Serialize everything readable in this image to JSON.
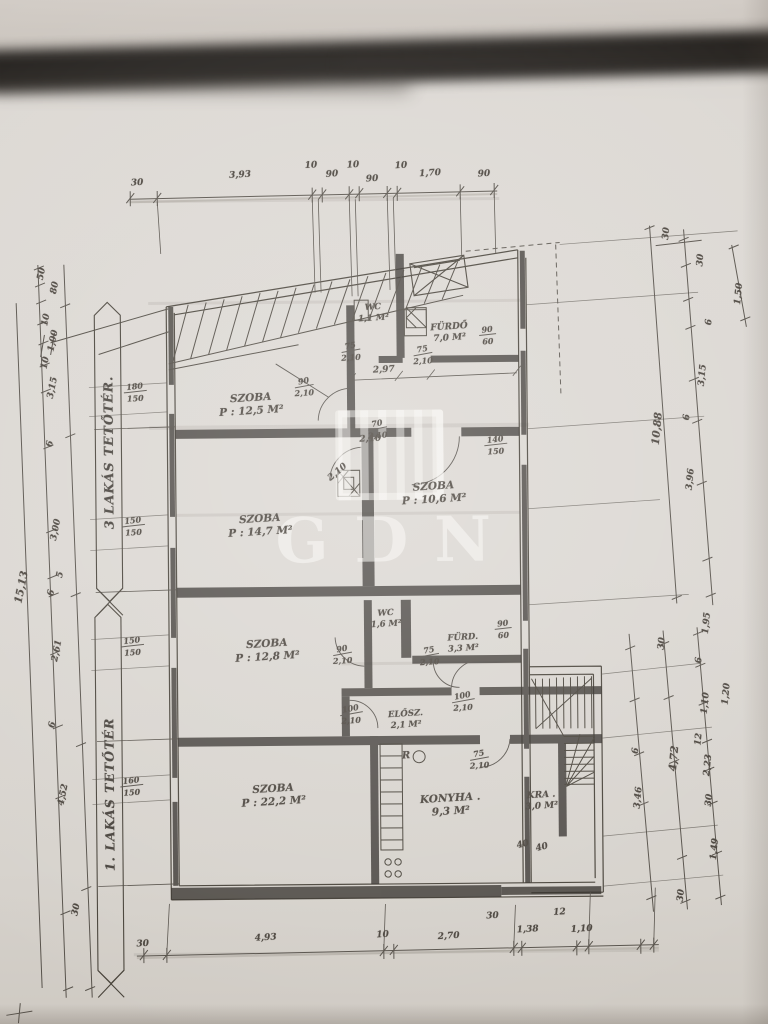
{
  "watermark": {
    "text": "GDN"
  },
  "banners": {
    "top": "3 LAKÁS TETŐTÉR.",
    "bottom": "1. LAKÁS TETŐTÉR"
  },
  "dims": {
    "top": [
      "30",
      "3,93",
      "10",
      "90",
      "10",
      "90",
      "10",
      "1,70",
      "90"
    ],
    "bottom": [
      "30",
      "4,93",
      "10",
      "2,70",
      "30",
      "1,38",
      "12",
      "1,10"
    ],
    "left": [
      "50",
      "80",
      "10",
      "1,00",
      "10",
      "3,15",
      "6",
      "3,00",
      "5",
      "6",
      "2,61",
      "6",
      "4,52",
      "30"
    ],
    "left_total": "15,13",
    "right_upper": [
      "30",
      "30",
      "1,50",
      "6",
      "3,15",
      "6",
      "3,96"
    ],
    "right_upper_total": "10,88",
    "right_lower": [
      "30",
      "1,20",
      "6",
      "3,46",
      "30"
    ],
    "right_lower_total": "4,72",
    "right_lower_inner": [
      "1,95",
      "6",
      "1,10",
      "12",
      "2,23",
      "30",
      "1,49"
    ],
    "interior": [
      "2,97",
      "2,10",
      "2,10"
    ]
  },
  "windows": {
    "left": [
      [
        "180",
        "150"
      ],
      [
        "150",
        "150"
      ],
      [
        "150",
        "150"
      ],
      [
        "160",
        "150"
      ]
    ],
    "right": [
      [
        "90",
        "60"
      ],
      [
        "140",
        "150"
      ],
      [
        "90",
        "60"
      ]
    ]
  },
  "rooms": [
    {
      "name": "SZOBA",
      "area": "P : 12,5 M²"
    },
    {
      "name": "WC",
      "area": "1,1 M²"
    },
    {
      "name": "FÜRDŐ",
      "area": "7,0 M²"
    },
    {
      "name": "SZOBA",
      "area": "P : 14,7 M²"
    },
    {
      "name": "SZOBA",
      "area": "P : 10,6 M²"
    },
    {
      "name": "SZOBA",
      "area": "P : 12,8 M²"
    },
    {
      "name": "WC",
      "area": "1,6 M²"
    },
    {
      "name": "FÜRD.",
      "area": "3,3 M²"
    },
    {
      "name": "ELŐSZ.",
      "area": "2,1 M²"
    },
    {
      "name": "SZOBA",
      "area": "P : 22,2 M²"
    },
    {
      "name": "KONYHA .",
      "area": "9,3 M²"
    },
    {
      "name": "KRA .",
      "area": "3,0 M²"
    }
  ],
  "doors": [
    {
      "w": "75",
      "h": "2,10"
    },
    {
      "w": "75",
      "h": "2,10"
    },
    {
      "w": "90",
      "h": "2,10"
    },
    {
      "w": "70",
      "h": "2,10"
    },
    {
      "w": "90",
      "h": "2,10"
    },
    {
      "w": "75",
      "h": "2,10"
    },
    {
      "w": "100",
      "h": "2,10"
    },
    {
      "w": "100",
      "h": "2,10"
    },
    {
      "w": "75",
      "h": "2,10"
    }
  ],
  "marks": {
    "r": "R",
    "forty_a": "40",
    "forty_b": "40"
  }
}
